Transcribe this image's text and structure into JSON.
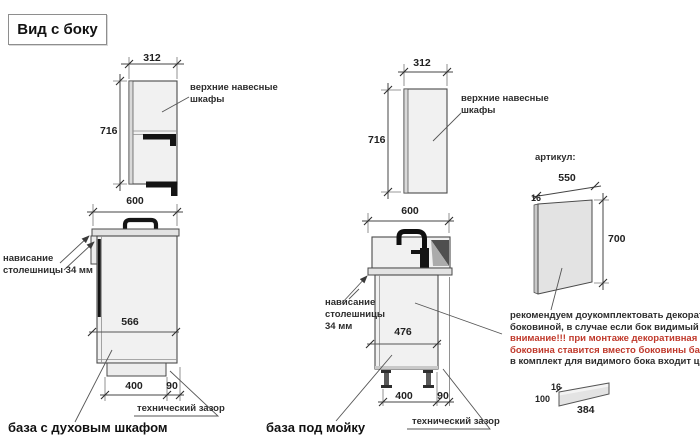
{
  "title": "Вид с боку",
  "labels": {
    "wall_cabinets": [
      "верхние навесные",
      "шкафы"
    ],
    "overhang_left": [
      "нависание",
      "столешницы 34 мм"
    ],
    "overhang_mid": [
      "нависание",
      "столешницы",
      "34 мм"
    ],
    "tech_gap": "технический зазор",
    "oven_base": "база с духовым шкафом",
    "sink_base": "база под мойку",
    "artikul": "артикул:"
  },
  "dims": {
    "wall_width": "312",
    "wall_height": "716",
    "base_width": "600",
    "oven_depth": "566",
    "sink_depth": "476",
    "plinth_width": "400",
    "gap_width": "90",
    "panel_width": "550",
    "panel_thickness": "16",
    "panel_height": "700",
    "plinth_thickness": "16",
    "plinth_height": "100",
    "plinth_length": "384"
  },
  "note": {
    "line1": "рекомендуем доукомплектовать декоративной",
    "line2": "боковиной, в случае если бок видимый",
    "line3": "внимание!!! при монтаже декоративная",
    "line4": "боковина ставится вместо боковины базы лдсп",
    "line5": "в комплект для видимого бока входит цоколь:"
  },
  "colors": {
    "warning_text": "#c0392b",
    "line": "#4a4a4a",
    "cabinet_fill": "#f1f1f1",
    "accent_black": "#141414"
  }
}
